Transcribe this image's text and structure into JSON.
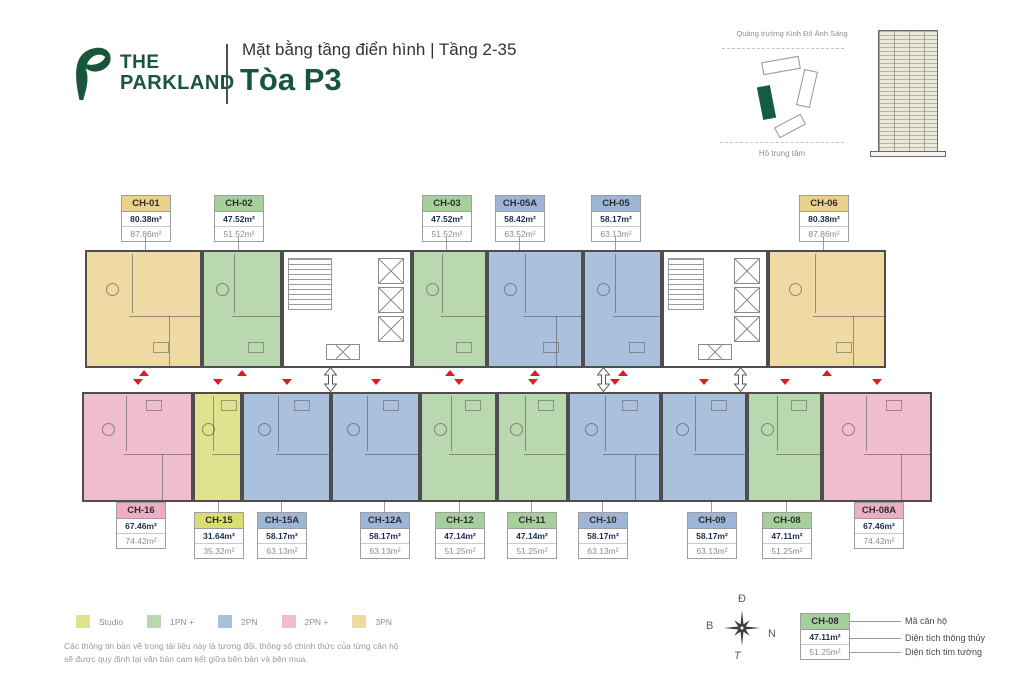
{
  "header": {
    "logo_line1": "THE",
    "logo_line2": "PARKLAND",
    "subtitle": "Mặt bằng tầng điển hình | Tầng 2-35",
    "title": "Tòa P3",
    "brand_color": "#17563b"
  },
  "minimap": {
    "top_label": "Quảng trường Kinh Đô Ánh Sáng",
    "bottom_label": "Hồ trung tâm"
  },
  "colors": {
    "studio": {
      "fill": "#dfe38f",
      "header": "#d9de73"
    },
    "1pn": {
      "fill": "#b9d8b0",
      "header": "#a7cf9e"
    },
    "2pn": {
      "fill": "#abc0dc",
      "header": "#9db5d6"
    },
    "2pnp": {
      "fill": "#efbdce",
      "header": "#edadc6"
    },
    "3pn": {
      "fill": "#eedaa2",
      "header": "#ead28c"
    }
  },
  "plan": {
    "top_units": [
      {
        "code": "CH-01",
        "area1": "80.38m²",
        "area2": "87.86m²",
        "type": "3pn",
        "x": 85,
        "w": 117,
        "label_x": 145
      },
      {
        "code": "CH-02",
        "area1": "47.52m²",
        "area2": "51.52m²",
        "type": "1pn",
        "x": 202,
        "w": 80,
        "label_x": 238
      },
      {
        "code": "CH-03",
        "area1": "47.52m²",
        "area2": "51.52m²",
        "type": "1pn",
        "x": 412,
        "w": 75,
        "label_x": 446
      },
      {
        "code": "CH-05A",
        "area1": "58.42m²",
        "area2": "63.52m²",
        "type": "2pn",
        "x": 487,
        "w": 96,
        "label_x": 519
      },
      {
        "code": "CH-05",
        "area1": "58.17m²",
        "area2": "63.13m²",
        "type": "2pn",
        "x": 583,
        "w": 79,
        "label_x": 615
      },
      {
        "code": "CH-06",
        "area1": "80.38m²",
        "area2": "87.86m²",
        "type": "3pn",
        "x": 768,
        "w": 118,
        "label_x": 823
      }
    ],
    "bottom_units": [
      {
        "code": "CH-16",
        "area1": "67.46m²",
        "area2": "74.42m²",
        "type": "2pnp",
        "x": 82,
        "w": 111,
        "label_x": 140,
        "label_y": 502
      },
      {
        "code": "CH-15",
        "area1": "31.64m²",
        "area2": "35.32m²",
        "type": "studio",
        "x": 193,
        "w": 49,
        "label_x": 218
      },
      {
        "code": "CH-15A",
        "area1": "58.17m²",
        "area2": "63.13m²",
        "type": "2pn",
        "x": 242,
        "w": 89,
        "label_x": 281
      },
      {
        "code": "CH-12A",
        "area1": "58.17m²",
        "area2": "63.13m²",
        "type": "2pn",
        "x": 331,
        "w": 89,
        "label_x": 384
      },
      {
        "code": "CH-12",
        "area1": "47.14m²",
        "area2": "51.25m²",
        "type": "1pn",
        "x": 420,
        "w": 77,
        "label_x": 459
      },
      {
        "code": "CH-11",
        "area1": "47.14m²",
        "area2": "51.25m²",
        "type": "1pn",
        "x": 497,
        "w": 71,
        "label_x": 531
      },
      {
        "code": "CH-10",
        "area1": "58.17m²",
        "area2": "63.13m²",
        "type": "2pn",
        "x": 568,
        "w": 93,
        "label_x": 602
      },
      {
        "code": "CH-09",
        "area1": "58.17m²",
        "area2": "63.13m²",
        "type": "2pn",
        "x": 661,
        "w": 86,
        "label_x": 711
      },
      {
        "code": "CH-08",
        "area1": "47.11m²",
        "area2": "51.25m²",
        "type": "1pn",
        "x": 747,
        "w": 75,
        "label_x": 786
      },
      {
        "code": "CH-08A",
        "area1": "67.46m²",
        "area2": "74.42m²",
        "type": "2pnp",
        "x": 822,
        "w": 110,
        "label_x": 878,
        "label_y": 502
      }
    ],
    "cores": [
      {
        "x": 282,
        "w": 130
      },
      {
        "x": 662,
        "w": 106
      }
    ]
  },
  "legend": {
    "items": [
      {
        "label": "Studio",
        "color": "#dfe38f"
      },
      {
        "label": "1PN +",
        "color": "#b9d8b0"
      },
      {
        "label": "2PN",
        "color": "#abc0dc"
      },
      {
        "label": "2PN +",
        "color": "#efbdce"
      },
      {
        "label": "3PN",
        "color": "#eedaa2"
      }
    ]
  },
  "disclaimer": {
    "line1": "Các thông tin bản vẽ trong tài liệu này là tương đối, thông số chính thức của từng căn hộ",
    "line2": "sẽ được quy định tại văn bản cam kết giữa bên bán và bên mua."
  },
  "compass": {
    "top": "Đ",
    "left": "B",
    "right": "N",
    "bottom": "T"
  },
  "key": {
    "code": "CH-08",
    "area1": "47.11m²",
    "area2": "51.25m²",
    "label_code": "Mã căn hộ",
    "label_area1": "Diện tích thông thủy",
    "label_area2": "Diện tích tim tường"
  }
}
